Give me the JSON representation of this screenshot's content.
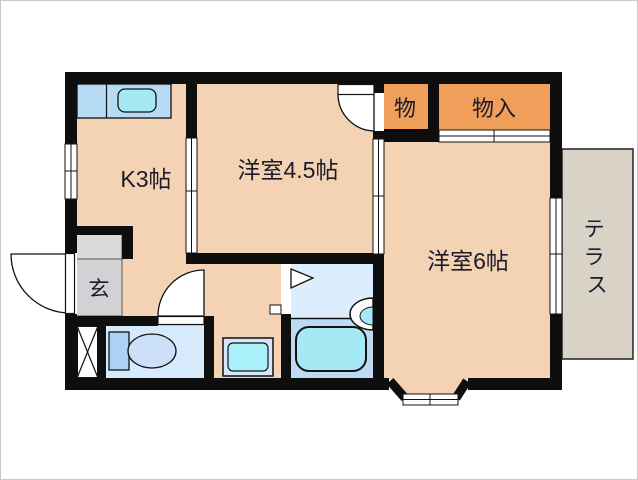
{
  "plan_type": "floorplan",
  "palette": {
    "wall": "#0e0e0e",
    "room_peach": "#f3d3b3",
    "closet_orange": "#f09f5a",
    "entrance_gray": "#d2d2d4",
    "entrance_step_gray": "#dadadc",
    "terrace_gray": "#d8d2c7",
    "toilet_room_blue": "#d6eafc",
    "bath_upper_blue": "#dceefd",
    "bath_lower_blue": "#bfd9f3",
    "counter_blue": "#b7daf5",
    "fixture_cyan": "#a5e9f5",
    "washpan_cyan": "#a9f0fb",
    "tank_blue": "#aed1f3",
    "bowl_blue": "#cbdff7",
    "text": "#1b1b2b"
  },
  "rooms": {
    "kitchen": {
      "label": "K3帖"
    },
    "western_room_45": {
      "label": "洋室4.5帖"
    },
    "western_room_6": {
      "label": "洋室6帖"
    },
    "storage_small": {
      "label": "物"
    },
    "storage_closet": {
      "label": "物入"
    },
    "entrance": {
      "label": "玄"
    },
    "terrace": {
      "label": "テラス",
      "chars": [
        "テ",
        "ラ",
        "ス"
      ]
    }
  },
  "fixtures": [
    "kitchen-sink",
    "toilet",
    "bathtub",
    "wash-basin",
    "washing-machine-pan",
    "shoe-cabinet-x",
    "bay-window"
  ]
}
